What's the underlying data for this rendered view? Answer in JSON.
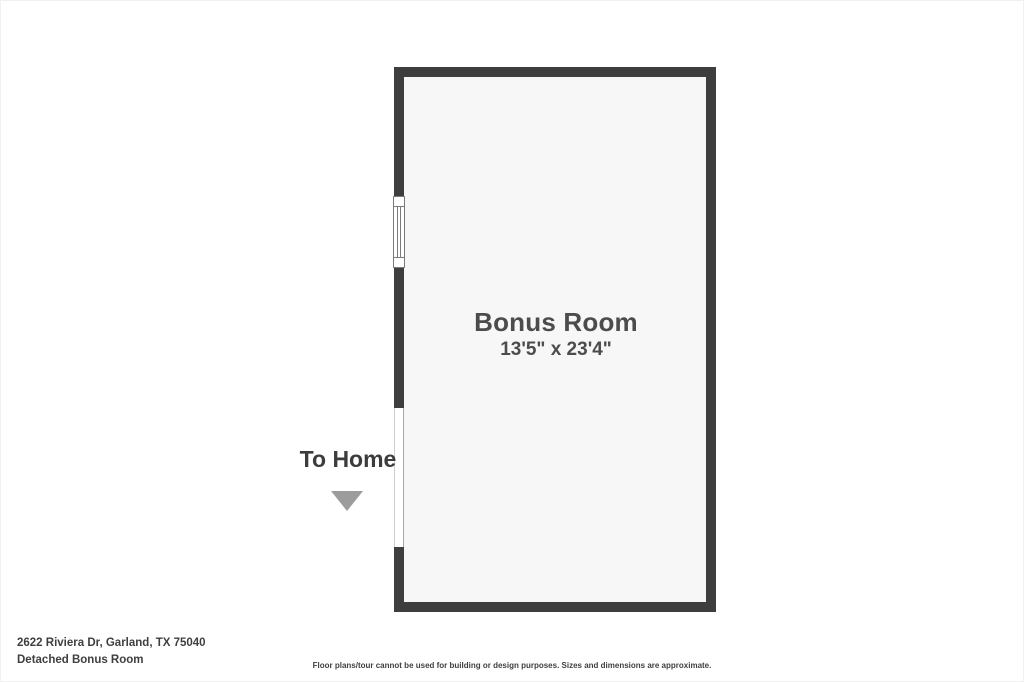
{
  "theme": {
    "page_bg": "#ffffff",
    "wall_color": "#3e3e3e",
    "floor_color": "#f7f7f7",
    "line_color": "#7a7a7a",
    "room_text": "#4c4c4c",
    "home_text": "#3c3c3c",
    "arrow_color": "#9c9c9c",
    "footer_text": "#3f3f3f"
  },
  "floorplan": {
    "room": {
      "name": "Bonus Room",
      "dimensions": "13'5\" x 23'4\""
    },
    "annotations": {
      "to_home_label": "To Home",
      "to_home_arrow_direction": "down"
    },
    "symbols": {
      "window": "window-icon",
      "door_opening": "wall-opening"
    }
  },
  "footer": {
    "address": "2622 Riviera Dr, Garland, TX 75040",
    "plan_name": "Detached Bonus Room",
    "disclaimer": "Floor plans/tour cannot be used for building or design purposes. Sizes and dimensions are approximate."
  }
}
